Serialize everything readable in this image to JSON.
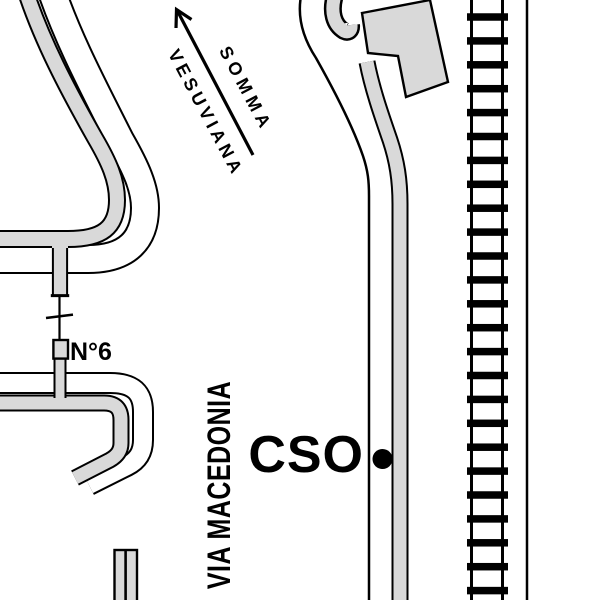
{
  "map": {
    "labels": {
      "direction_word1": "SOMMA",
      "direction_word2": "VESUVIANA",
      "house_number": "N°6",
      "street_name": "VIA MACEDONIA",
      "station_label": "CSO"
    },
    "colors": {
      "road_fill": "#d9d9d9",
      "line_ink": "#000000",
      "background": "#ffffff"
    },
    "railway": {
      "tie_count": 25,
      "tie_start_y": 17,
      "tie_spacing": 23.9,
      "tie_x": 467,
      "tie_width": 41,
      "tie_height": 7.5
    }
  }
}
